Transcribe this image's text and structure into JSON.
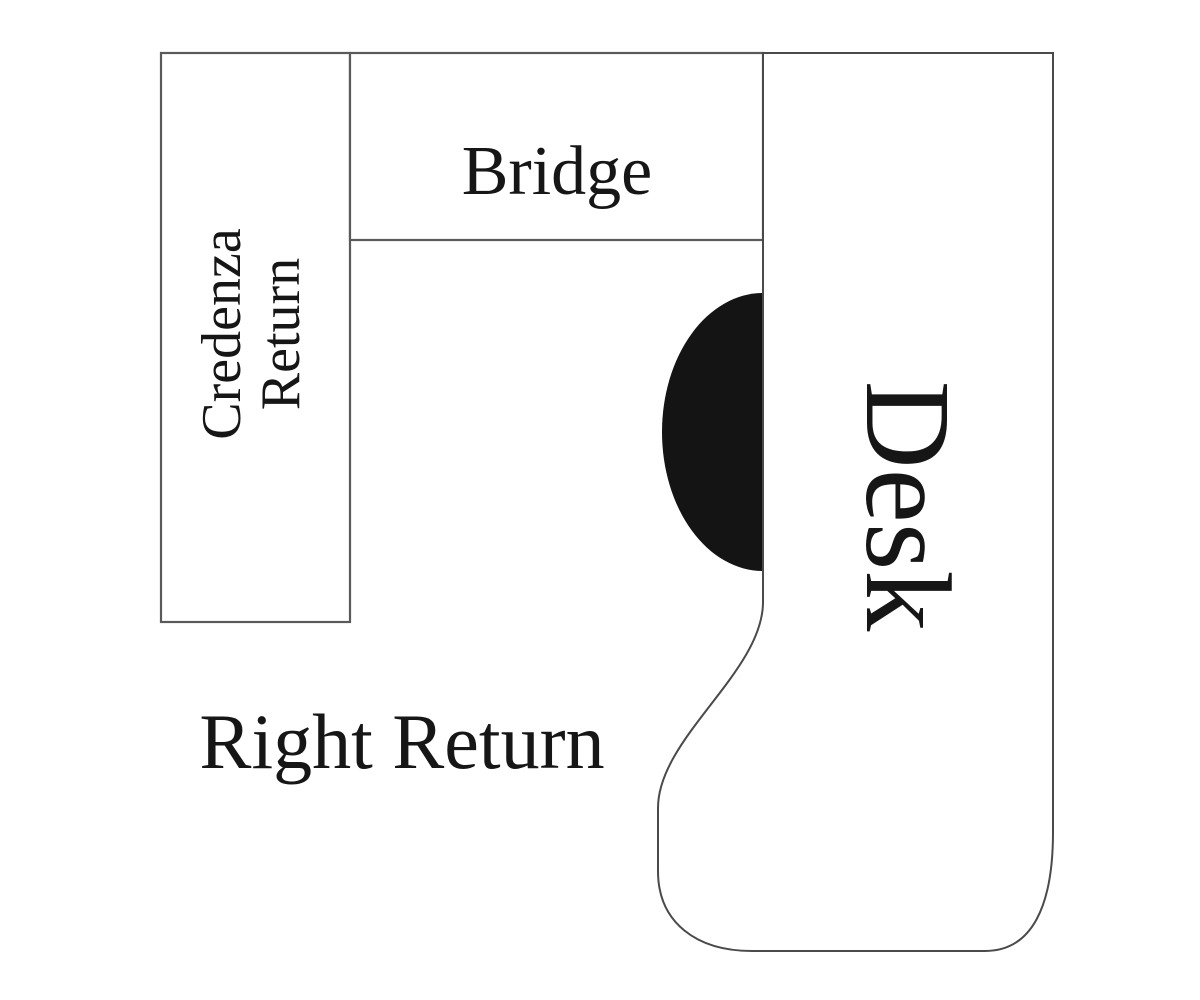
{
  "diagram": {
    "type": "office-desk-layout-plan",
    "background_color": "#ffffff",
    "line_color": "#4a4a4a",
    "text_color": "#161616",
    "components": {
      "credenza_return": {
        "label_line1": "Credenza",
        "label_line2": "Return",
        "text_rotation": "90deg-counterclockwise"
      },
      "bridge": {
        "label": "Bridge"
      },
      "desk": {
        "label": "Desk",
        "text_rotation": "90deg-clockwise"
      },
      "right_return": {
        "label": "Right Return"
      },
      "chair": {
        "shape": "half-ellipse",
        "fill": "#141414"
      }
    }
  }
}
